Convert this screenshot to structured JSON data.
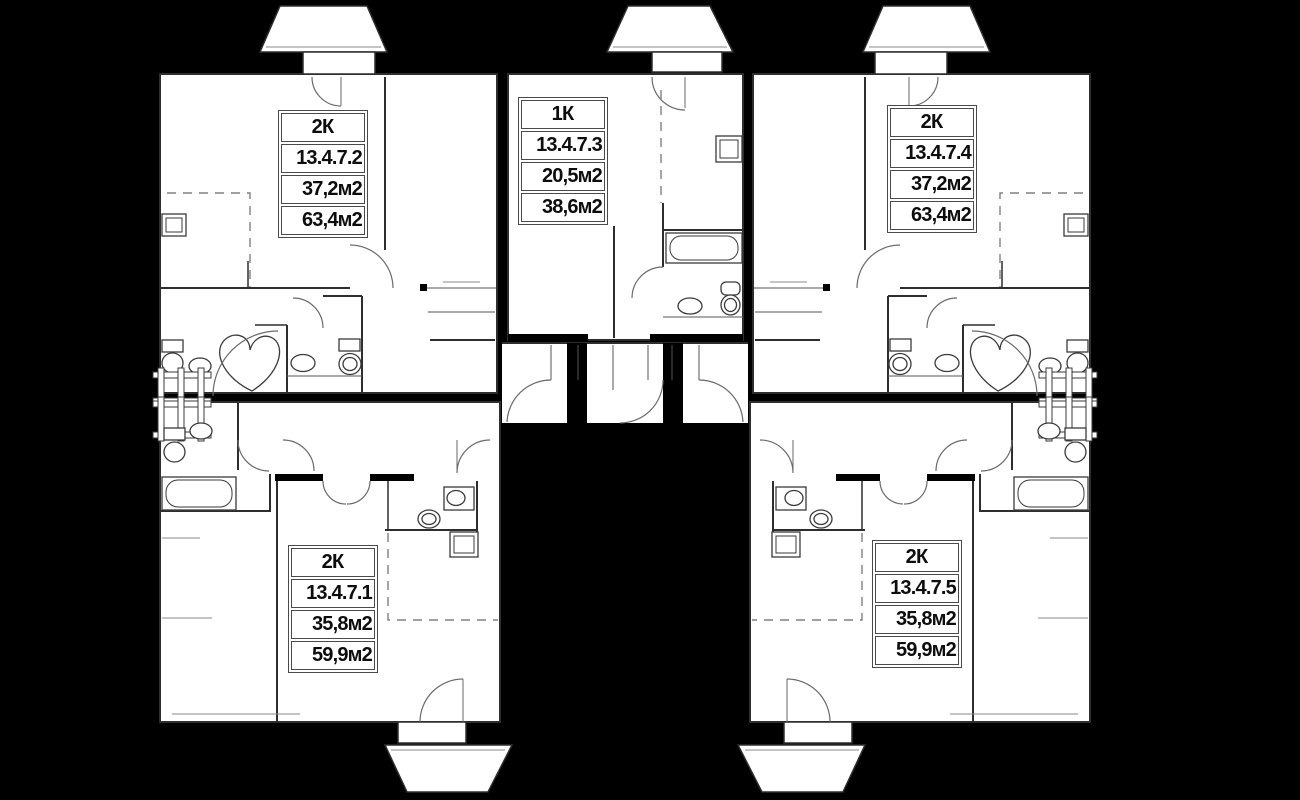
{
  "plan": {
    "background_color": "#000000",
    "floor_color": "#ffffff",
    "wall_color": "#000000",
    "thin_line_color": "#2e2e2e",
    "arc_line_color": "#6a6a6a",
    "dashed_line_color": "#808080",
    "units": [
      {
        "id": "top-left",
        "rooms_label": "2К",
        "number": "13.4.7.2",
        "living_area": "37,2м2",
        "total_area": "63,4м2"
      },
      {
        "id": "top-middle",
        "rooms_label": "1К",
        "number": "13.4.7.3",
        "living_area": "20,5м2",
        "total_area": "38,6м2"
      },
      {
        "id": "top-right",
        "rooms_label": "2К",
        "number": "13.4.7.4",
        "living_area": "37,2м2",
        "total_area": "63,4м2"
      },
      {
        "id": "bottom-left",
        "rooms_label": "2К",
        "number": "13.4.7.1",
        "living_area": "35,8м2",
        "total_area": "59,9м2"
      },
      {
        "id": "bottom-right",
        "rooms_label": "2К",
        "number": "13.4.7.5",
        "living_area": "35,8м2",
        "total_area": "59,9м2"
      }
    ]
  }
}
